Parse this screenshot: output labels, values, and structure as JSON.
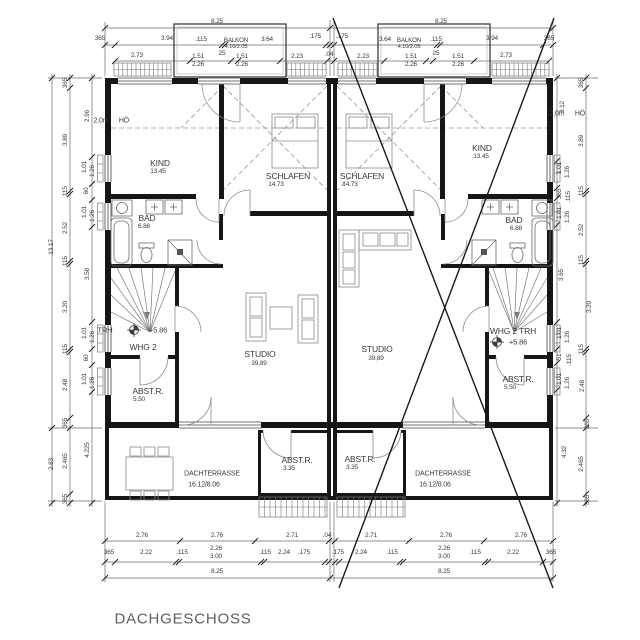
{
  "drawing": {
    "title": "DACHGESCHOSS"
  },
  "labels": [
    {
      "t": "8.25",
      "x": 217,
      "y": 22
    },
    {
      "t": "8.25",
      "x": 441,
      "y": 22
    },
    {
      "t": "365",
      "x": 100,
      "y": 39
    },
    {
      "t": "3.94",
      "x": 167,
      "y": 39
    },
    {
      "t": ".115",
      "x": 201,
      "y": 40
    },
    {
      "t": "BALKON",
      "x": 236,
      "y": 41,
      "s": 6.2,
      "name": "balkon-label-left"
    },
    {
      "t": "4.10/2.05",
      "x": 236,
      "y": 48,
      "s": 5.8,
      "name": "balkon-size-left"
    },
    {
      "t": "3.64",
      "x": 267,
      "y": 40
    },
    {
      "t": ".175",
      "x": 315,
      "y": 37
    },
    {
      "t": ".175",
      "x": 342,
      "y": 37
    },
    {
      "t": "3.64",
      "x": 385,
      "y": 40
    },
    {
      "t": "BALKON",
      "x": 409,
      "y": 41,
      "s": 6.2,
      "name": "balkon-label-right"
    },
    {
      "t": "4.10/2.05",
      "x": 409,
      "y": 48,
      "s": 5.8,
      "name": "balkon-size-right"
    },
    {
      "t": ".115",
      "x": 436,
      "y": 40
    },
    {
      "t": "3.94",
      "x": 492,
      "y": 39
    },
    {
      "t": "365",
      "x": 549,
      "y": 39
    },
    {
      "t": "2.73",
      "x": 137,
      "y": 56
    },
    {
      "t": "1.51",
      "x": 198,
      "y": 57
    },
    {
      "t": "2.26",
      "x": 198,
      "y": 65
    },
    {
      "t": "25",
      "x": 222,
      "y": 54
    },
    {
      "t": "1.51",
      "x": 242,
      "y": 57
    },
    {
      "t": "2.26",
      "x": 242,
      "y": 65
    },
    {
      "t": "2.23",
      "x": 297,
      "y": 57
    },
    {
      "t": ".04",
      "x": 329,
      "y": 55
    },
    {
      "t": "2.23",
      "x": 363,
      "y": 57
    },
    {
      "t": "1.51",
      "x": 411,
      "y": 57
    },
    {
      "t": "2.26",
      "x": 411,
      "y": 65
    },
    {
      "t": "25",
      "x": 436,
      "y": 54
    },
    {
      "t": "1.51",
      "x": 458,
      "y": 57
    },
    {
      "t": "2.26",
      "x": 458,
      "y": 65
    },
    {
      "t": "2.73",
      "x": 506,
      "y": 56
    },
    {
      "t": "2.0m",
      "x": 101,
      "y": 121,
      "s": 7,
      "name": "height-line-label-left"
    },
    {
      "t": "HÖ",
      "x": 124,
      "y": 121,
      "s": 7,
      "name": "height-line-label-left-2"
    },
    {
      "t": "2.0m",
      "x": 557,
      "y": 114,
      "s": 7,
      "name": "height-line-label-right"
    },
    {
      "t": "HÖ",
      "x": 580,
      "y": 114,
      "s": 7,
      "name": "height-line-label-right-2"
    },
    {
      "t": "KIND",
      "x": 160,
      "y": 163,
      "s": 8.5,
      "name": "room-label-kind-left"
    },
    {
      "t": "13.45",
      "x": 158,
      "y": 172,
      "name": "room-area-kind-left"
    },
    {
      "t": "SCHLAFEN",
      "x": 288,
      "y": 176,
      "s": 8.5,
      "name": "room-label-schlafen-left"
    },
    {
      "t": "14.73",
      "x": 276,
      "y": 185,
      "name": "room-area-schlafen-left"
    },
    {
      "t": "SCHLAFEN",
      "x": 362,
      "y": 176,
      "s": 8.5,
      "name": "room-label-schlafen-right"
    },
    {
      "t": "14.73",
      "x": 350,
      "y": 185,
      "name": "room-area-schlafen-right"
    },
    {
      "t": "KIND",
      "x": 482,
      "y": 148,
      "s": 8.5,
      "name": "room-label-kind-right"
    },
    {
      "t": "13.45",
      "x": 481,
      "y": 157,
      "name": "room-area-kind-right"
    },
    {
      "t": "BAD",
      "x": 147,
      "y": 218,
      "s": 8.5,
      "name": "room-label-bad-left"
    },
    {
      "t": "6.88",
      "x": 144,
      "y": 227,
      "name": "room-area-bad-left"
    },
    {
      "t": "BAD",
      "x": 514,
      "y": 220,
      "s": 8.5,
      "name": "room-label-bad-right"
    },
    {
      "t": "6.88",
      "x": 516,
      "y": 229,
      "name": "room-area-bad-right"
    },
    {
      "t": "TRH",
      "x": 105,
      "y": 330,
      "s": 7.5,
      "name": "stair-label-left"
    },
    {
      "t": "+5.86",
      "x": 158,
      "y": 330,
      "s": 7.5,
      "name": "level-value-left"
    },
    {
      "t": "WHG 2",
      "x": 143,
      "y": 347,
      "s": 8.5,
      "name": "apartment-label-left"
    },
    {
      "t": "ABST.R.",
      "x": 148,
      "y": 391,
      "s": 8.5,
      "name": "room-label-abstr-left"
    },
    {
      "t": "5.50",
      "x": 139,
      "y": 400,
      "name": "room-area-abstr-left"
    },
    {
      "t": "WHG 2 TRH",
      "x": 513,
      "y": 331,
      "s": 8.5,
      "name": "apartment-label-right"
    },
    {
      "t": "+5.86",
      "x": 518,
      "y": 342,
      "s": 7.5,
      "name": "level-value-right"
    },
    {
      "t": "ABST.R.",
      "x": 518,
      "y": 379,
      "s": 8.5,
      "name": "room-label-abstr-right"
    },
    {
      "t": "5.50",
      "x": 510,
      "y": 388,
      "name": "room-area-abstr-right"
    },
    {
      "t": "STUDIO",
      "x": 260,
      "y": 354,
      "s": 8.5,
      "name": "room-label-studio-left"
    },
    {
      "t": "39,89",
      "x": 259,
      "y": 364,
      "name": "room-area-studio-left"
    },
    {
      "t": "STUDIO",
      "x": 377,
      "y": 349,
      "s": 8.5,
      "name": "room-label-studio-right"
    },
    {
      "t": "39,89",
      "x": 376,
      "y": 359,
      "name": "room-area-studio-right"
    },
    {
      "t": "ABST.R.",
      "x": 297,
      "y": 460,
      "s": 8.5,
      "name": "room-label-terrace-abstr-left"
    },
    {
      "t": "3.35",
      "x": 289,
      "y": 469,
      "name": "room-area-terrace-abstr-left"
    },
    {
      "t": "ABST.R.",
      "x": 360,
      "y": 459,
      "s": 8.5,
      "name": "room-label-terrace-abstr-right"
    },
    {
      "t": "3.35",
      "x": 352,
      "y": 468,
      "name": "room-area-terrace-abstr-right"
    },
    {
      "t": "DACHTERRASSE",
      "x": 212,
      "y": 474,
      "s": 7,
      "name": "room-label-terrace-left"
    },
    {
      "t": "16.12/8.06",
      "x": 204,
      "y": 485,
      "s": 7,
      "name": "room-area-terrace-left"
    },
    {
      "t": "DACHTERRASSE",
      "x": 443,
      "y": 474,
      "s": 7,
      "name": "room-label-terrace-right"
    },
    {
      "t": "16.12/8.06",
      "x": 435,
      "y": 485,
      "s": 7,
      "name": "room-area-terrace-right"
    },
    {
      "t": "2.76",
      "x": 142,
      "y": 536
    },
    {
      "t": "2.76",
      "x": 217,
      "y": 536
    },
    {
      "t": "2.71",
      "x": 292,
      "y": 536
    },
    {
      "t": ".04",
      "x": 327,
      "y": 536
    },
    {
      "t": "2.71",
      "x": 371,
      "y": 536
    },
    {
      "t": "2.76",
      "x": 446,
      "y": 536
    },
    {
      "t": "2.76",
      "x": 521,
      "y": 536
    },
    {
      "t": "365",
      "x": 109,
      "y": 553
    },
    {
      "t": "2.22",
      "x": 146,
      "y": 553
    },
    {
      "t": ".115",
      "x": 182,
      "y": 553
    },
    {
      "t": "2.26",
      "x": 216,
      "y": 549
    },
    {
      "t": "3.00",
      "x": 216,
      "y": 557
    },
    {
      "t": ".115",
      "x": 265,
      "y": 553
    },
    {
      "t": "2.24",
      "x": 284,
      "y": 553
    },
    {
      "t": ".175",
      "x": 304,
      "y": 553
    },
    {
      "t": ".175",
      "x": 338,
      "y": 553
    },
    {
      "t": "2.24",
      "x": 361,
      "y": 553
    },
    {
      "t": ".115",
      "x": 392,
      "y": 553
    },
    {
      "t": "2.26",
      "x": 444,
      "y": 549
    },
    {
      "t": "3.00",
      "x": 444,
      "y": 557
    },
    {
      "t": ".115",
      "x": 475,
      "y": 553
    },
    {
      "t": "2.22",
      "x": 513,
      "y": 553
    },
    {
      "t": "365",
      "x": 551,
      "y": 553
    },
    {
      "t": "8.25",
      "x": 217,
      "y": 572
    },
    {
      "t": "8.25",
      "x": 444,
      "y": 572
    },
    {
      "t": "13.17",
      "x": 52,
      "y": 247,
      "r": -90
    },
    {
      "t": "2.83",
      "x": 52,
      "y": 464,
      "r": -90
    },
    {
      "t": "365",
      "x": 66,
      "y": 83,
      "r": -90
    },
    {
      "t": "3.89",
      "x": 66,
      "y": 140,
      "r": -90
    },
    {
      "t": ".115",
      "x": 66,
      "y": 192,
      "r": -90
    },
    {
      "t": "2.52",
      "x": 66,
      "y": 228,
      "r": -90
    },
    {
      "t": ".115",
      "x": 66,
      "y": 262,
      "r": -90
    },
    {
      "t": "3.20",
      "x": 66,
      "y": 307,
      "r": -90
    },
    {
      "t": ".115",
      "x": 66,
      "y": 350,
      "r": -90
    },
    {
      "t": "2.48",
      "x": 66,
      "y": 385,
      "r": -90
    },
    {
      "t": "365",
      "x": 66,
      "y": 423,
      "r": -90
    },
    {
      "t": "2.465",
      "x": 66,
      "y": 461,
      "r": -90
    },
    {
      "t": "365",
      "x": 66,
      "y": 499,
      "r": -90
    },
    {
      "t": "2.96",
      "x": 88,
      "y": 116,
      "r": -90
    },
    {
      "t": "1.01",
      "x": 85,
      "y": 167,
      "r": -90
    },
    {
      "t": "1.26",
      "x": 93,
      "y": 171,
      "r": -90
    },
    {
      "t": "60",
      "x": 87,
      "y": 191,
      "r": -90
    },
    {
      "t": "1.01",
      "x": 85,
      "y": 212,
      "r": -90
    },
    {
      "t": "1.26",
      "x": 93,
      "y": 216,
      "r": -90
    },
    {
      "t": "3.58",
      "x": 88,
      "y": 274,
      "r": -90
    },
    {
      "t": "1.01",
      "x": 85,
      "y": 333,
      "r": -90
    },
    {
      "t": "1.26",
      "x": 93,
      "y": 337,
      "r": -90
    },
    {
      "t": "60",
      "x": 87,
      "y": 358,
      "r": -90
    },
    {
      "t": "1.01",
      "x": 85,
      "y": 379,
      "r": -90
    },
    {
      "t": "1.26",
      "x": 93,
      "y": 383,
      "r": -90
    },
    {
      "t": "4.225",
      "x": 88,
      "y": 450,
      "r": -90
    },
    {
      "t": "3.12",
      "x": 563,
      "y": 107,
      "r": -90
    },
    {
      "t": "1.01",
      "x": 560,
      "y": 168,
      "r": -90
    },
    {
      "t": "1.26",
      "x": 568,
      "y": 172,
      "r": -90
    },
    {
      "t": "365",
      "x": 560,
      "y": 194,
      "r": -90
    },
    {
      "t": ".115",
      "x": 569,
      "y": 197,
      "r": -90
    },
    {
      "t": "1.01",
      "x": 560,
      "y": 213,
      "r": -90
    },
    {
      "t": "1.26",
      "x": 568,
      "y": 217,
      "r": -90
    },
    {
      "t": "3.65",
      "x": 562,
      "y": 275,
      "r": -90
    },
    {
      "t": "1.01",
      "x": 560,
      "y": 333,
      "r": -90
    },
    {
      "t": "1.26",
      "x": 568,
      "y": 337,
      "r": -90
    },
    {
      "t": "51",
      "x": 560,
      "y": 357,
      "r": -90
    },
    {
      "t": ".115",
      "x": 570,
      "y": 360,
      "r": -90
    },
    {
      "t": "1.01",
      "x": 560,
      "y": 379,
      "r": -90
    },
    {
      "t": "1.26",
      "x": 568,
      "y": 383,
      "r": -90
    },
    {
      "t": "4.32",
      "x": 565,
      "y": 452,
      "r": -90
    },
    {
      "t": "365",
      "x": 582,
      "y": 83,
      "r": -90
    },
    {
      "t": "3.89",
      "x": 582,
      "y": 141,
      "r": -90
    },
    {
      "t": ".115",
      "x": 582,
      "y": 192,
      "r": -90
    },
    {
      "t": "2.52",
      "x": 582,
      "y": 230,
      "r": -90
    },
    {
      "t": ".115",
      "x": 582,
      "y": 261,
      "r": -90
    },
    {
      "t": "3.20",
      "x": 590,
      "y": 307,
      "r": -90
    },
    {
      "t": ".115",
      "x": 582,
      "y": 350,
      "r": -90
    },
    {
      "t": "2.48",
      "x": 583,
      "y": 386,
      "r": -90
    },
    {
      "t": "365",
      "x": 588,
      "y": 424,
      "r": -90
    },
    {
      "t": "2.465",
      "x": 582,
      "y": 464,
      "r": -90
    },
    {
      "t": "365",
      "x": 588,
      "y": 500,
      "r": -90
    }
  ]
}
